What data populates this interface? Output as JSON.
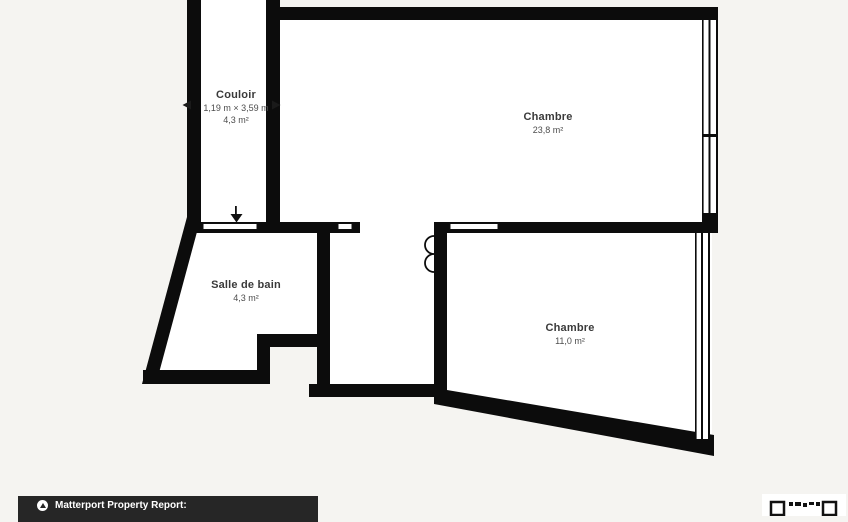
{
  "colors": {
    "background": "#f5f4f1",
    "wall": "#0c0c0c",
    "room_fill": "#ffffff",
    "label_text": "#3a3a3a",
    "footer_bg": "#262626",
    "footer_text": "#ffffff"
  },
  "floorplan": {
    "rooms": [
      {
        "id": "couloir",
        "name": "Couloir",
        "dimensions": "1,19 m × 3,59 m",
        "area": "4,3 m²"
      },
      {
        "id": "chambre-1",
        "name": "Chambre",
        "area": "23,8 m²"
      },
      {
        "id": "salle-de-bain",
        "name": "Salle de bain",
        "area": "4,3 m²"
      },
      {
        "id": "chambre-2",
        "name": "Chambre",
        "area": "11,0 m²"
      }
    ]
  },
  "footer": {
    "label": "Matterport Property Report:"
  }
}
